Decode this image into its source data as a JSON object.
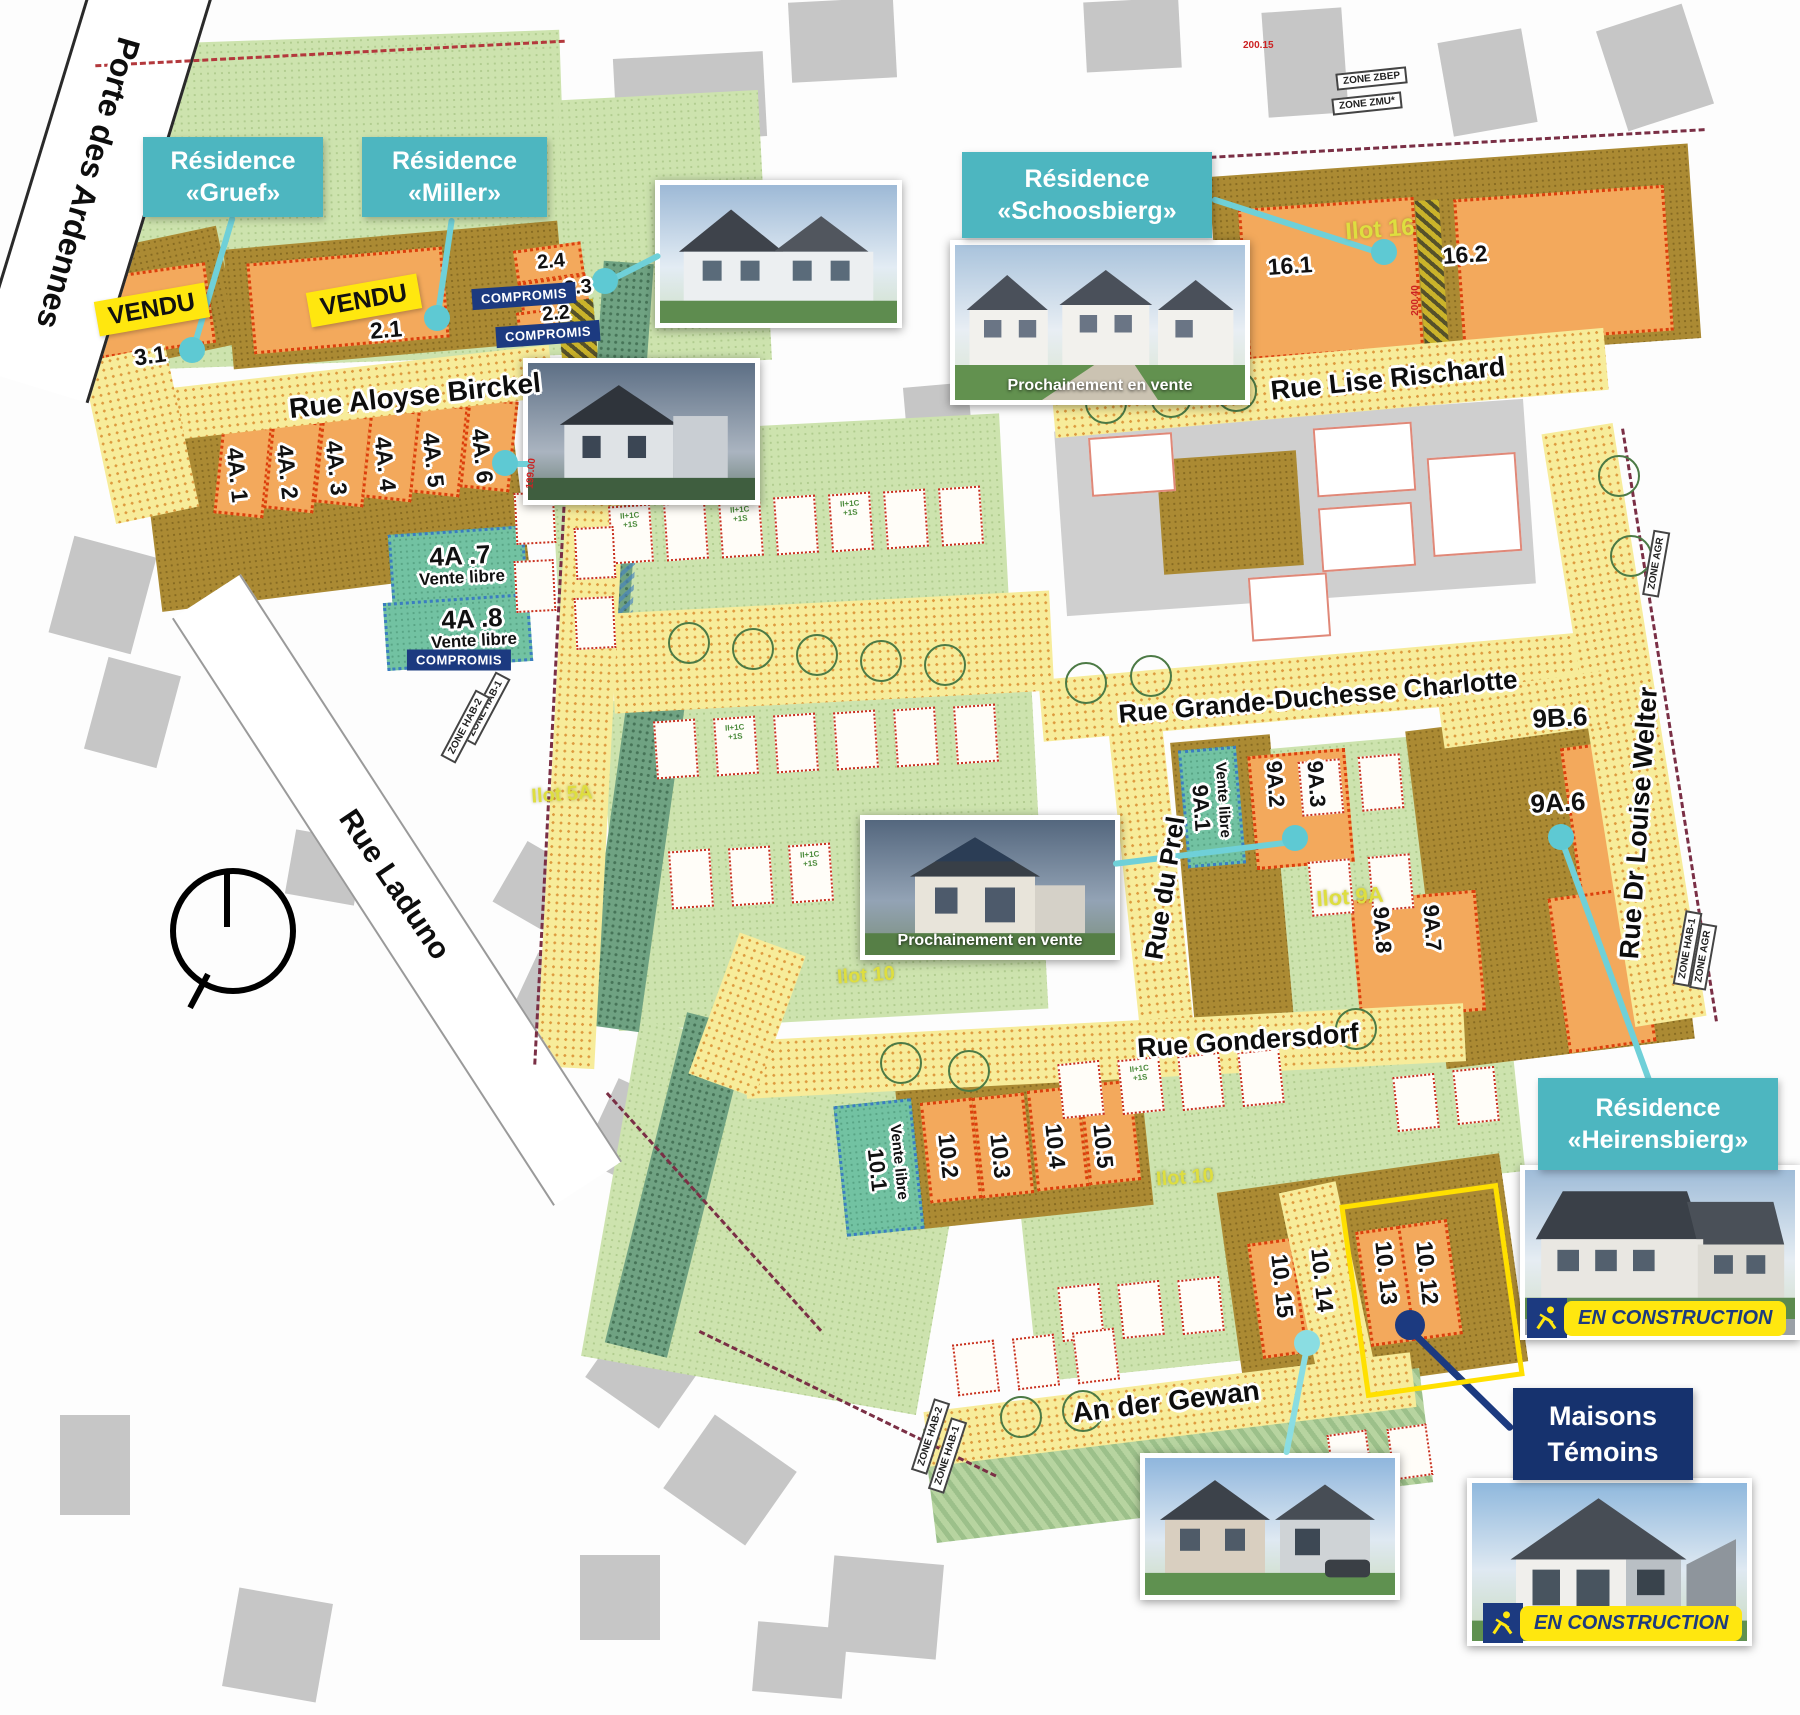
{
  "streets": {
    "porte": "Porte des Ardennes",
    "birckel": "Rue Aloyse Birckel",
    "rischard": "Rue Lise Rischard",
    "charlotte": "Rue Grande-Duchesse Charlotte",
    "prel": "Rue du Prel",
    "welter": "Rue Dr Louise Welter",
    "gondersdorf": "Rue Gondersdorf",
    "gewan": "An der Gewan",
    "laduno": "Rue Laduno"
  },
  "residences": {
    "gruef": {
      "line1": "Résidence",
      "line2": "«Gruef»"
    },
    "miller": {
      "line1": "Résidence",
      "line2": "«Miller»"
    },
    "schoosbierg": {
      "line1": "Résidence",
      "line2": "«Schoosbierg»"
    },
    "heirensbierg": {
      "line1": "Résidence",
      "line2": "«Heirensbierg»"
    }
  },
  "maisons_temoins": {
    "line1": "Maisons",
    "line2": "Témoins"
  },
  "badges": {
    "vendu": "VENDU",
    "compromis": "COMPROMIS",
    "vente_libre": "Vente libre",
    "en_construction": "EN CONSTRUCTION",
    "prochainement": "Prochainement en vente"
  },
  "lots": {
    "l3_1": "3.1",
    "l2_1": "2.1",
    "l2_2": "2.2",
    "l2_3": "2.3",
    "l2_4": "2.4",
    "l4a_1": "4A. 1",
    "l4a_2": "4A. 2",
    "l4a_3": "4A. 3",
    "l4a_4": "4A. 4",
    "l4a_5": "4A. 5",
    "l4a_6": "4A. 6",
    "l4a_7": "4A .7",
    "l4a_8": "4A .8",
    "l16_1": "16.1",
    "l16_2": "16.2",
    "l9b_6": "9B.6",
    "l9a_1": "9A.1",
    "l9a_2": "9A.2",
    "l9a_3": "9A.3",
    "l9a_6": "9A.6",
    "l9a_7": "9A.7",
    "l9a_8": "9A.8",
    "l10_1": "10.1",
    "l10_2": "10.2",
    "l10_3": "10.3",
    "l10_4": "10.4",
    "l10_5": "10.5",
    "l10_12": "10. 12",
    "l10_13": "10. 13",
    "l10_14": "10. 14",
    "l10_15": "10. 15"
  },
  "ilots": {
    "i16": "Ilot 16",
    "i9a": "Ilot 9A",
    "i10": "Ilot 10",
    "i5a": "Ilot 5A"
  },
  "zones": {
    "zbep": "ZONE ZBEP",
    "zmu": "ZONE ZMU*",
    "hab1": "ZONE HAB-1",
    "hab2": "ZONE HAB-2",
    "agr": "ZONE AGR"
  },
  "elevations": {
    "e1": "200.15",
    "e2": "200.40",
    "e3": "199.00"
  },
  "house_annotations": {
    "a1": "II+1C",
    "a2": "+1S"
  },
  "colors": {
    "teal_label": "#4db6c0",
    "navy": "#1c3a80",
    "badge_yellow": "#ffe70f",
    "olive_lot": "#ab8a33",
    "orange_lot": "#f3a95c",
    "pale_green": "#cde3ae",
    "street_yellow": "#f7ec9a",
    "vente_libre_green": "#72c2a2",
    "lot_border_red": "#dc3f0c",
    "highlight_yellow": "#ffe000"
  }
}
